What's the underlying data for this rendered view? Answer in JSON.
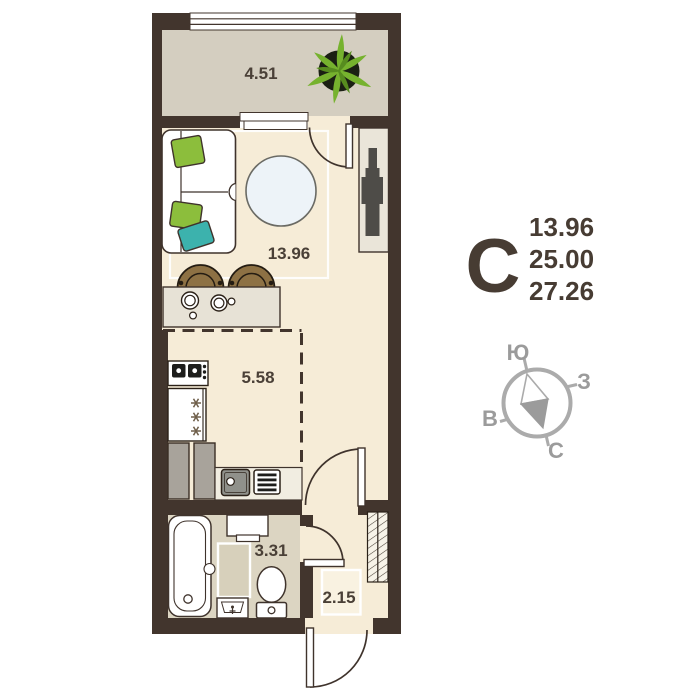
{
  "plan": {
    "rooms": {
      "balcony": {
        "area": "4.51"
      },
      "living": {
        "area": "13.96"
      },
      "kitchen": {
        "area": "5.58"
      },
      "bathroom": {
        "area": "3.31"
      },
      "hallway": {
        "area": "2.15"
      }
    },
    "legend": {
      "type_letter": "С",
      "living_area": "13.96",
      "total_area": "25.00",
      "total_with_balcony": "27.26"
    },
    "compass": {
      "top": "Ю",
      "right": "З",
      "bottom": "С",
      "left": "В"
    },
    "colors": {
      "wall": "#42352d",
      "floor_main": "#f6ecd7",
      "floor_balcony": "#d4cec0",
      "floor_bathroom": "#dcd5c2",
      "counter": "#e7e2d6",
      "cabinet_grey": "#a8a39b",
      "stool_brown": "#8d7144",
      "pillow_green": "#8cbe3c",
      "pillow_teal": "#3cb2ad",
      "plant_green": "#76b22e",
      "rug_blue": "#edf3f8",
      "compass_grey": "#ababab",
      "text": "#473c33"
    }
  }
}
